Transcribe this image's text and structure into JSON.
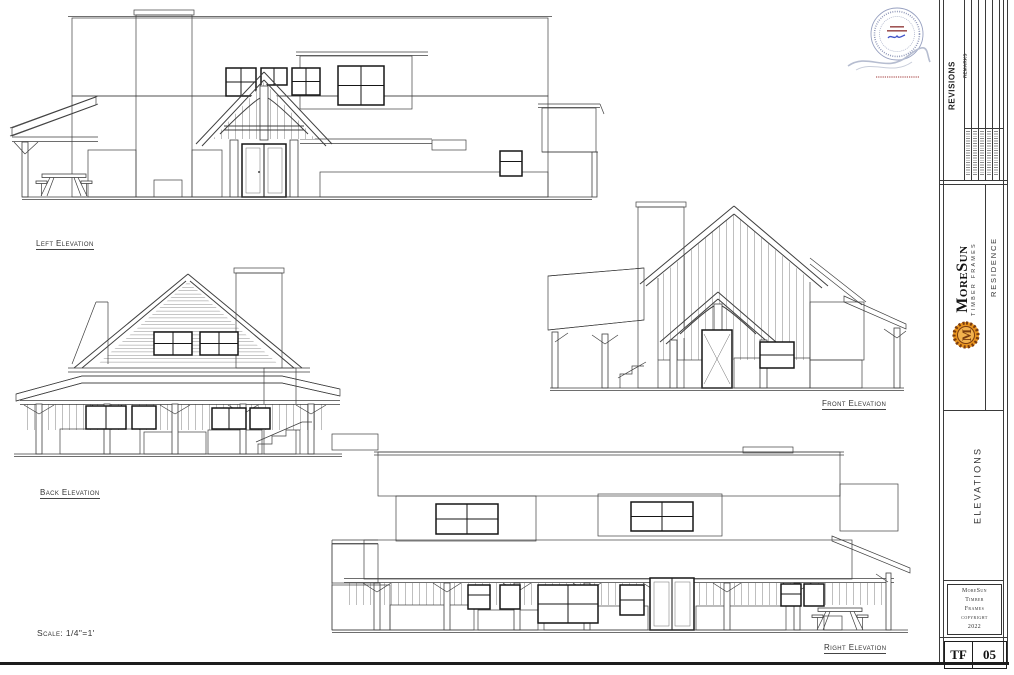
{
  "drawings": {
    "left": {
      "label": "Left Elevation"
    },
    "back": {
      "label": "Back Elevation"
    },
    "front": {
      "label": "Front Elevation"
    },
    "right": {
      "label": "Right Elevation"
    },
    "scale_note": "Scale: 1/4\"=1'"
  },
  "title_block": {
    "revisions": {
      "title": "REVISIONS",
      "column_header": "REMARKS"
    },
    "logo": {
      "name": "MoreSun",
      "tagline": "Timber Frames",
      "monogram": "M"
    },
    "project": "RESIDENCE",
    "sheet_title": "ELEVATIONS",
    "copyright": {
      "lines": [
        "MoreSun",
        "Timber",
        "Frames",
        "copyright",
        "2022"
      ]
    },
    "sheet_code": "TF",
    "sheet_number": "05"
  },
  "icons": {
    "seal": "professional-engineer-seal",
    "signature": "handwritten-signature",
    "sun_logo": "moresun-sun-logo",
    "picnic_table": "picnic-table-drawing"
  },
  "colors": {
    "logo_orange": "#e8941f",
    "logo_orange_light": "#f2b14d",
    "logo_brown": "#7a3c10",
    "seal_blue": "#8b93b5",
    "seal_red": "#c58d8d",
    "line_dark": "#1c1c1c"
  }
}
